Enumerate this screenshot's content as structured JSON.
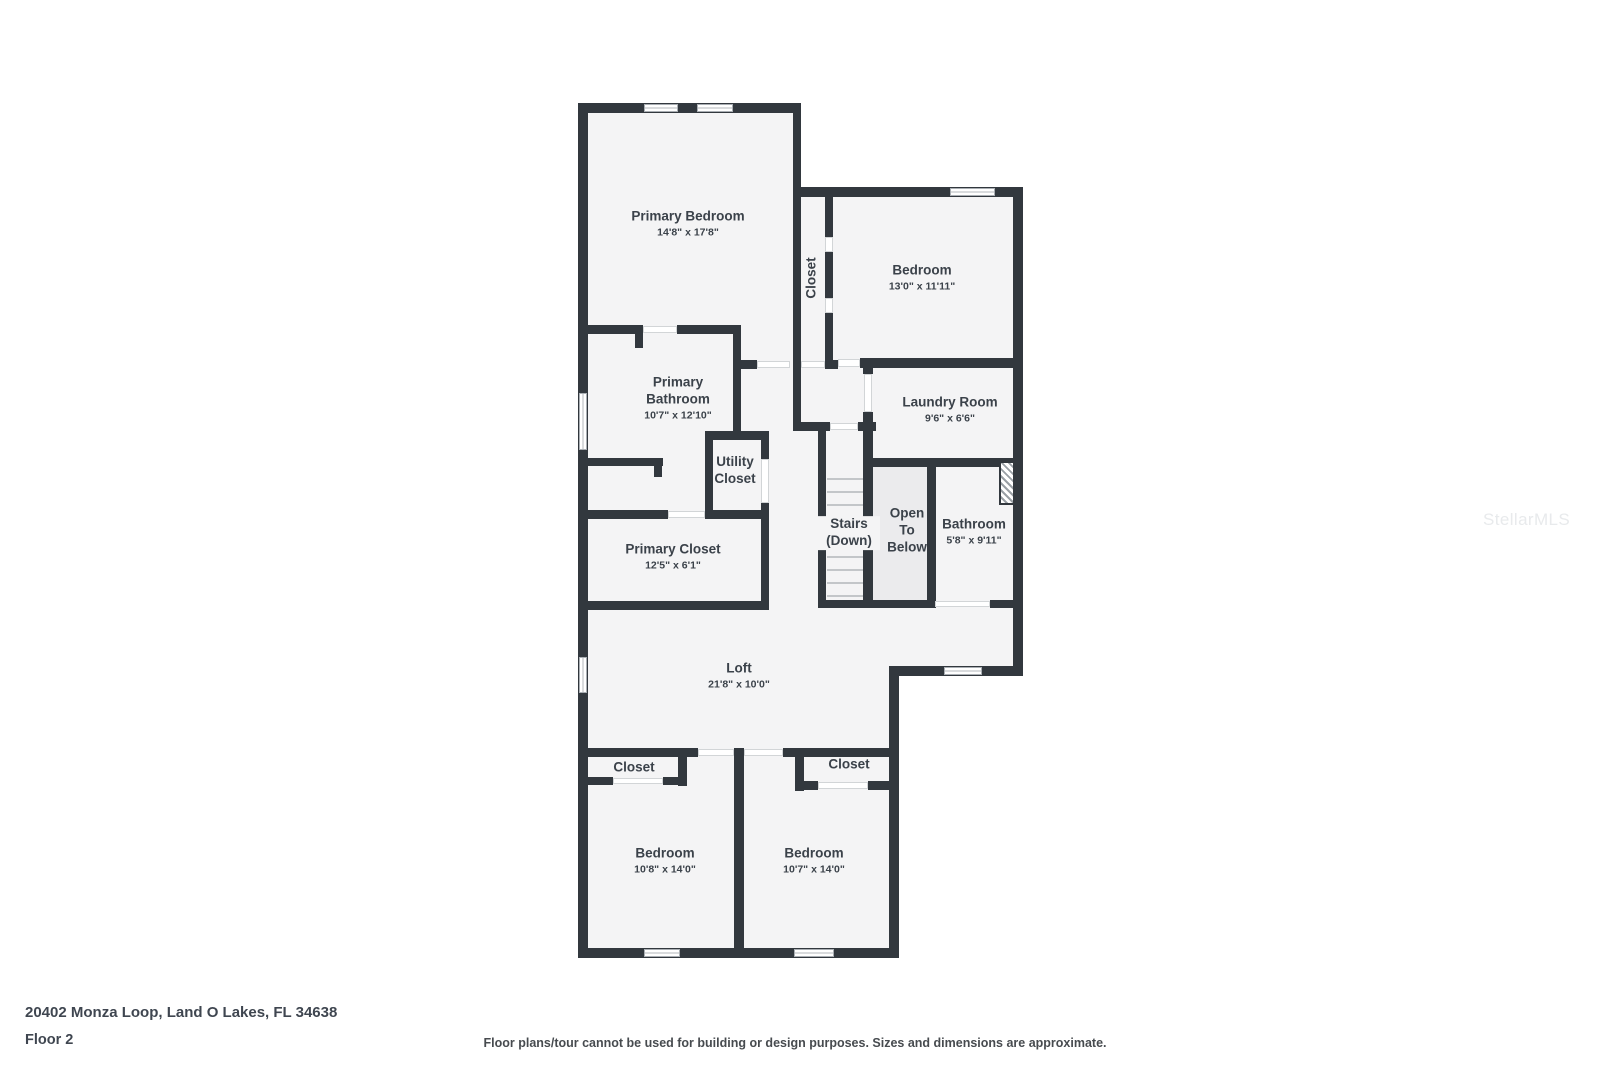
{
  "watermark": "StellarMLS",
  "footer": {
    "address": "20402 Monza Loop, Land O Lakes, FL 34638",
    "floor": "Floor 2",
    "disclaimer": "Floor plans/tour cannot be used for building or design purposes. Sizes and dimensions are approximate."
  },
  "rooms": {
    "primary_bedroom": {
      "name": "Primary Bedroom",
      "dims": "14'8\" x 17'8\""
    },
    "closet_hall": {
      "name": "Closet"
    },
    "bedroom_top": {
      "name": "Bedroom",
      "dims": "13'0\" x 11'11\""
    },
    "primary_bathroom": {
      "name": "Primary Bathroom",
      "dims": "10'7\" x 12'10\""
    },
    "laundry": {
      "name": "Laundry Room",
      "dims": "9'6\" x 6'6\""
    },
    "utility_closet": {
      "name": "Utility Closet"
    },
    "stairs": {
      "name": "Stairs (Down)"
    },
    "open_below": {
      "name": "Open To Below"
    },
    "bathroom": {
      "name": "Bathroom",
      "dims": "5'8\" x 9'11\""
    },
    "primary_closet": {
      "name": "Primary Closet",
      "dims": "12'5\" x 6'1\""
    },
    "loft": {
      "name": "Loft",
      "dims": "21'8\" x 10'0\""
    },
    "closet_left": {
      "name": "Closet"
    },
    "closet_right": {
      "name": "Closet"
    },
    "bedroom_bottom_left": {
      "name": "Bedroom",
      "dims": "10'8\" x 14'0\""
    },
    "bedroom_bottom_right": {
      "name": "Bedroom",
      "dims": "10'7\" x 14'0\""
    }
  },
  "colors": {
    "wall": "#32383e",
    "floor": "#f4f4f5",
    "open_area": "#ebebed",
    "label_text": "#3b424a"
  }
}
